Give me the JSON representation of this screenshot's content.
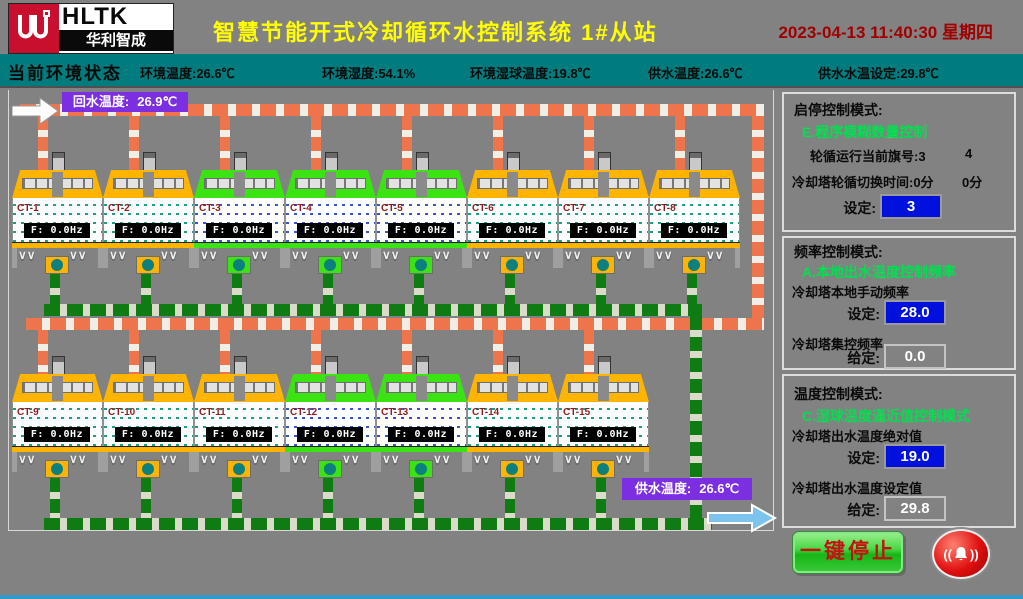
{
  "header": {
    "brand": "HLTK",
    "brand_cn": "华利智成",
    "title": "智慧节能开式冷却循环水控制系统 1#从站",
    "datetime": "2023-04-13 11:40:30 星期四"
  },
  "env_bar": {
    "label": "当前环境状态",
    "items": [
      "环境温度:26.6℃",
      "环境湿度:54.1%",
      "环境湿球温度:19.8℃",
      "供水温度:26.6℃",
      "供水水温设定:29.8℃"
    ]
  },
  "scada": {
    "return_water": {
      "label": "回水温度:",
      "value": "26.9℃"
    },
    "supply_water": {
      "label": "供水温度:",
      "value": "26.6℃"
    },
    "towers": [
      {
        "id": "CT-1",
        "freq": "F:  0.0Hz",
        "running": false
      },
      {
        "id": "CT-2",
        "freq": "F:  0.0Hz",
        "running": false
      },
      {
        "id": "CT-3",
        "freq": "F:  0.0Hz",
        "running": true
      },
      {
        "id": "CT-4",
        "freq": "F:  0.0Hz",
        "running": true
      },
      {
        "id": "CT-5",
        "freq": "F:  0.0Hz",
        "running": true
      },
      {
        "id": "CT-6",
        "freq": "F:  0.0Hz",
        "running": false
      },
      {
        "id": "CT-7",
        "freq": "F:  0.0Hz",
        "running": false
      },
      {
        "id": "CT-8",
        "freq": "F:  0.0Hz",
        "running": false
      },
      {
        "id": "CT-9",
        "freq": "F:  0.0Hz",
        "running": false
      },
      {
        "id": "CT-10",
        "freq": "F:  0.0Hz",
        "running": false
      },
      {
        "id": "CT-11",
        "freq": "F:  0.0Hz",
        "running": false
      },
      {
        "id": "CT-12",
        "freq": "F:  0.0Hz",
        "running": true
      },
      {
        "id": "CT-13",
        "freq": "F:  0.0Hz",
        "running": true
      },
      {
        "id": "CT-14",
        "freq": "F:  0.0Hz",
        "running": false
      },
      {
        "id": "CT-15",
        "freq": "F:  0.0Hz",
        "running": false
      }
    ]
  },
  "panel": {
    "sections": [
      {
        "title": "启停控制模式:",
        "mode": "E.程序模糊数量控制",
        "info_rows": [
          {
            "text": "轮循运行当前旗号:3",
            "extra": "4"
          },
          {
            "text": "冷却塔轮循切换时间:0分",
            "extra": "0分"
          }
        ],
        "fields": [
          {
            "caption": "",
            "label": "设定:",
            "value": "3",
            "style": "set"
          }
        ]
      },
      {
        "title": "频率控制模式:",
        "mode": "A.本地出水温度控制频率",
        "info_rows": [],
        "fields": [
          {
            "caption": "冷却塔本地手动频率",
            "label": "设定:",
            "value": "28.0",
            "style": "set"
          },
          {
            "caption": "冷却塔集控频率",
            "label": "给定:",
            "value": "0.0",
            "style": "give"
          }
        ]
      },
      {
        "title": "温度控制模式:",
        "mode": "C.湿球温度逼近值控制模式",
        "info_rows": [],
        "fields": [
          {
            "caption": "冷却塔出水温度绝对值",
            "label": "设定:",
            "value": "19.0",
            "style": "set"
          },
          {
            "caption": "冷却塔出水温度设定值",
            "label": "给定:",
            "value": "29.8",
            "style": "give"
          }
        ]
      }
    ],
    "stop_button": "一键停止",
    "alarm_icon": "alarm-bell"
  },
  "colors": {
    "title_yellow": "#FFFF00",
    "date_red": "#A00000",
    "env_teal": "#007B7E",
    "pipe_orange": "#ED744B",
    "pipe_green": "#0E7C12",
    "running_green": "#3BE313",
    "idle_yellow": "#FFB400",
    "input_blue": "#0011DD",
    "mode_green": "#00E050",
    "label_purple": "#7B2FE0"
  }
}
